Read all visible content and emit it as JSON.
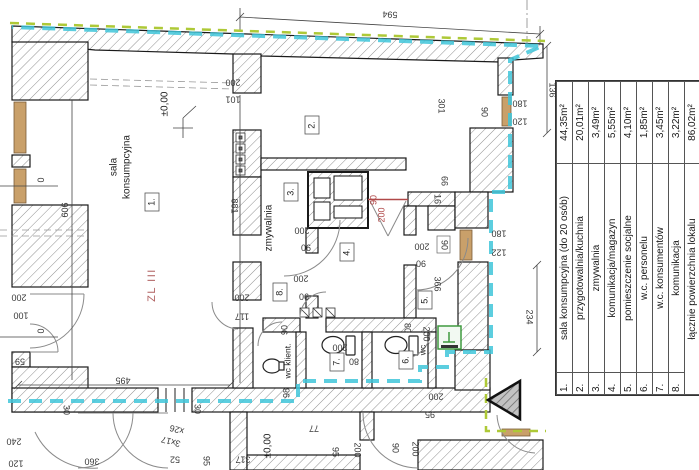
{
  "legend": {
    "rows": [
      {
        "num": "1.",
        "name": "sala konsumpcyjna (do 20 osób)",
        "area": "44,35m²"
      },
      {
        "num": "2.",
        "name": "przygotowalnia/kuchnia",
        "area": "20,01m²"
      },
      {
        "num": "3.",
        "name": "zmywalnia",
        "area": "3,49m²"
      },
      {
        "num": "4.",
        "name": "komunikacja/magazyn",
        "area": "5,55m²"
      },
      {
        "num": "5.",
        "name": "pomieszczenie socjalne",
        "area": "4,10m²"
      },
      {
        "num": "6.",
        "name": "w.c. personelu",
        "area": "1,85m²"
      },
      {
        "num": "7.",
        "name": "w.c. konsumentów",
        "area": "3,45m²"
      },
      {
        "num": "8.",
        "name": "komunikacja",
        "area": "3,22m²"
      },
      {
        "num": "",
        "name": "łącznie powierzchnia lokalu",
        "area": "86,02m²"
      }
    ]
  },
  "plan": {
    "dims": [
      {
        "t": "594",
        "x": 390,
        "y": 14,
        "r": 183
      },
      {
        "t": "136",
        "x": 552,
        "y": 90,
        "r": 90
      },
      {
        "t": "180",
        "x": 520,
        "y": 103,
        "r": 180
      },
      {
        "t": "120",
        "x": 520,
        "y": 121,
        "r": 180
      },
      {
        "t": "90",
        "x": 484,
        "y": 112,
        "r": 90
      },
      {
        "t": "301",
        "x": 441,
        "y": 106,
        "r": 90
      },
      {
        "t": "66",
        "x": 444,
        "y": 181,
        "r": 90
      },
      {
        "t": "16",
        "x": 437,
        "y": 199,
        "r": 90
      },
      {
        "t": "180",
        "x": 499,
        "y": 233,
        "r": 180
      },
      {
        "t": "122",
        "x": 499,
        "y": 252,
        "r": 180
      },
      {
        "t": "90",
        "x": 444,
        "y": 245,
        "r": 90
      },
      {
        "t": "366",
        "x": 437,
        "y": 284,
        "r": 90
      },
      {
        "t": "234",
        "x": 529,
        "y": 317,
        "r": 90
      },
      {
        "t": "909",
        "x": 64,
        "y": 210,
        "r": 90
      },
      {
        "t": "881",
        "x": 234,
        "y": 206,
        "r": 90
      },
      {
        "t": "200",
        "x": 233,
        "y": 82,
        "r": 180
      },
      {
        "t": "101",
        "x": 233,
        "y": 99,
        "r": 180
      },
      {
        "t": "0",
        "x": 40,
        "y": 180,
        "r": 90
      },
      {
        "t": "0",
        "x": 40,
        "y": 331,
        "r": 90
      },
      {
        "t": "200",
        "x": 19,
        "y": 297,
        "r": 180
      },
      {
        "t": "100",
        "x": 21,
        "y": 315,
        "r": 180
      },
      {
        "t": "59",
        "x": 20,
        "y": 361,
        "r": 180
      },
      {
        "t": "495",
        "x": 123,
        "y": 380,
        "r": 180
      },
      {
        "t": "30",
        "x": 197,
        "y": 409,
        "r": 90
      },
      {
        "t": "30",
        "x": 66,
        "y": 410,
        "r": 90
      },
      {
        "t": "240",
        "x": 14,
        "y": 441,
        "r": 180
      },
      {
        "t": "120",
        "x": 16,
        "y": 463,
        "r": 180
      },
      {
        "t": "95",
        "x": 206,
        "y": 461,
        "r": 90
      },
      {
        "t": "360",
        "x": 92,
        "y": 461,
        "r": 180
      },
      {
        "t": "52",
        "x": 175,
        "y": 459,
        "r": 180
      },
      {
        "t": "317",
        "x": 243,
        "y": 459,
        "r": 180
      },
      {
        "t": "77",
        "x": 314,
        "y": 428,
        "r": 180
      },
      {
        "t": "95",
        "x": 335,
        "y": 452,
        "r": 90
      },
      {
        "t": "200",
        "x": 357,
        "y": 450,
        "r": 90
      },
      {
        "t": "90",
        "x": 395,
        "y": 448,
        "r": 90
      },
      {
        "t": "200",
        "x": 415,
        "y": 449,
        "r": 90
      },
      {
        "t": "200",
        "x": 436,
        "y": 396,
        "r": 180
      },
      {
        "t": "95",
        "x": 430,
        "y": 414,
        "r": 180
      },
      {
        "t": "200",
        "x": 302,
        "y": 230,
        "r": 180
      },
      {
        "t": "90",
        "x": 306,
        "y": 247,
        "r": 180
      },
      {
        "t": "200",
        "x": 301,
        "y": 278,
        "r": 180
      },
      {
        "t": "90",
        "x": 304,
        "y": 296,
        "r": 180
      },
      {
        "t": "200",
        "x": 422,
        "y": 246,
        "r": 180
      },
      {
        "t": "90",
        "x": 421,
        "y": 263,
        "r": 180
      },
      {
        "t": "200",
        "x": 242,
        "y": 297,
        "r": 180
      },
      {
        "t": "117",
        "x": 242,
        "y": 316,
        "r": 180
      },
      {
        "t": "200",
        "x": 340,
        "y": 347,
        "r": 180
      },
      {
        "t": "80",
        "x": 354,
        "y": 361,
        "r": 180
      },
      {
        "t": "80",
        "x": 407,
        "y": 328,
        "r": 90
      },
      {
        "t": "200",
        "x": 426,
        "y": 334,
        "r": 90
      },
      {
        "t": "90",
        "x": 285,
        "y": 330,
        "r": -90
      },
      {
        "t": "98",
        "x": 287,
        "y": 393,
        "r": -90
      },
      {
        "t": "90",
        "x": 374,
        "y": 200,
        "r": -90,
        "c": "red"
      },
      {
        "t": "200",
        "x": 382,
        "y": 215,
        "r": -90,
        "c": "red"
      },
      {
        "t": "3x17",
        "x": 171,
        "y": 441,
        "r": 195
      },
      {
        "t": "x26",
        "x": 177,
        "y": 429,
        "r": 195
      }
    ],
    "texts": [
      {
        "t": "sala",
        "x": 114,
        "y": 167,
        "r": -90,
        "c": "name"
      },
      {
        "t": "konsumpcyjna",
        "x": 127,
        "y": 167,
        "r": -90,
        "c": "name"
      },
      {
        "t": "zmywalnia",
        "x": 269,
        "y": 228,
        "r": -90,
        "c": "name"
      },
      {
        "t": "wc klient.",
        "x": 288,
        "y": 361,
        "r": -90,
        "c": "name small"
      },
      {
        "t": "wc",
        "x": 423,
        "y": 350,
        "r": -90,
        "c": "name small"
      },
      {
        "t": "ZL III",
        "x": 152,
        "y": 285,
        "r": -90,
        "c": "zone"
      },
      {
        "t": "±0,00",
        "x": 165,
        "y": 104,
        "r": -90,
        "c": "name"
      },
      {
        "t": "±0,00",
        "x": 268,
        "y": 446,
        "r": -90,
        "c": "name"
      }
    ],
    "room_labels": [
      {
        "t": "1.",
        "x": 152,
        "y": 202
      },
      {
        "t": "2.",
        "x": 312,
        "y": 125
      },
      {
        "t": "3.",
        "x": 291,
        "y": 192
      },
      {
        "t": "4.",
        "x": 347,
        "y": 252
      },
      {
        "t": "5.",
        "x": 425,
        "y": 300
      },
      {
        "t": "6.",
        "x": 406,
        "y": 360
      },
      {
        "t": "7.",
        "x": 337,
        "y": 362
      },
      {
        "t": "8.",
        "x": 280,
        "y": 292
      }
    ]
  },
  "colors": {
    "fire_zone_line_cyan": "#3fc6d9",
    "site_boundary_lime": "#aec937",
    "dim_red": "#b04848",
    "zone_text_red": "#b06060",
    "window_sill_brown": "#c9a06a",
    "wall_outline": "#1a1a1a",
    "green_fixture": "#3f9a3f"
  }
}
